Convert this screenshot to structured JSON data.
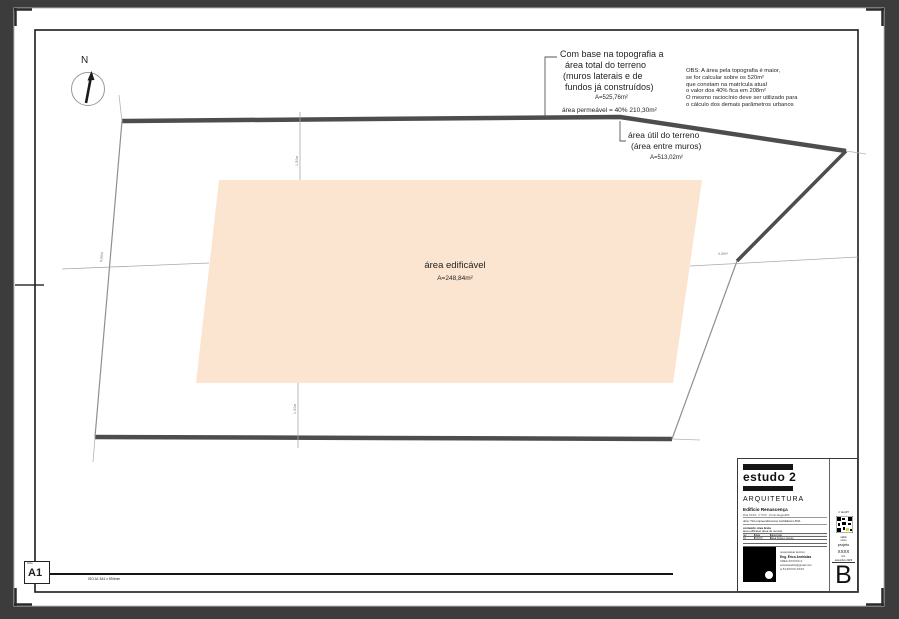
{
  "colors": {
    "canvas_bg": "#3c3c3c",
    "sheet": "#ffffff",
    "wall": "#4d4d4d",
    "buildable_fill": "#fce5d0",
    "stamp_yellow": "#ded82a"
  },
  "north": {
    "label": "N"
  },
  "plan": {
    "topo": {
      "line1": "Com base na topografia a",
      "line2": "área total do terreno",
      "line3": "(muros laterais e de",
      "line4": "fundos já construídos)",
      "area": "A=525,76m²",
      "permeavel": "área permeável = 40% 210,30m²"
    },
    "obs": {
      "line1": "OBS: A área pela topografia é maior,",
      "line2": "se for calcular sobre os 520m²",
      "line3": "que constam na matrícula atual",
      "line4": "o valor dos 40% fica em 208m²",
      "line5": "O mesmo raciocínio deve ser utilizado para",
      "line6": "o cálculo dos demais parâmetros urbanos"
    },
    "util": {
      "line1": "área útil do terreno",
      "line2": "(área entre muros)",
      "area": "A=513,02m²"
    },
    "edificavel": {
      "title": "área edificável",
      "area": "A=248,84m²"
    },
    "dims": {
      "left": "4,00m",
      "top": "1,50m",
      "bottom": "1,50m",
      "right": "3,00m"
    }
  },
  "titleblock": {
    "logo_text": "estudo 2",
    "discipline": "ARQUITETURA",
    "project_name": "Edifício Renascença",
    "project_address": "Rua XXXX, nº XXX - Porto Alegre/RS",
    "owner": "obra:  TGI empreendimentos imobiliários LTDA",
    "content_label": "conteúdo: área bruta",
    "content_value": "área edificável (área de recuos)",
    "table": {
      "headers": [
        "rev",
        "data",
        "descrição"
      ],
      "row": [
        "01",
        "XX/XX",
        "área bruta e recuos"
      ]
    },
    "contact": {
      "line1": "responsável técnico:",
      "line2": "Eng. Érico Andriolas",
      "line3": "CREA XXXXXX-X",
      "line4": "estudoandrio@gmail.com",
      "line5": "w 51 9XXXX-XXXX"
    },
    "stamp": {
      "top_note": "nº da ART",
      "note1": "válido",
      "note2": "como",
      "projeto_label": "projeto",
      "projeto_value": "XXXX",
      "rev_label": "rev.",
      "date": "setembro 2023",
      "revision": "B"
    }
  },
  "footer": {
    "format_caption": "folha",
    "format": "A1",
    "size": "ISO A1    841 x 594mm"
  }
}
